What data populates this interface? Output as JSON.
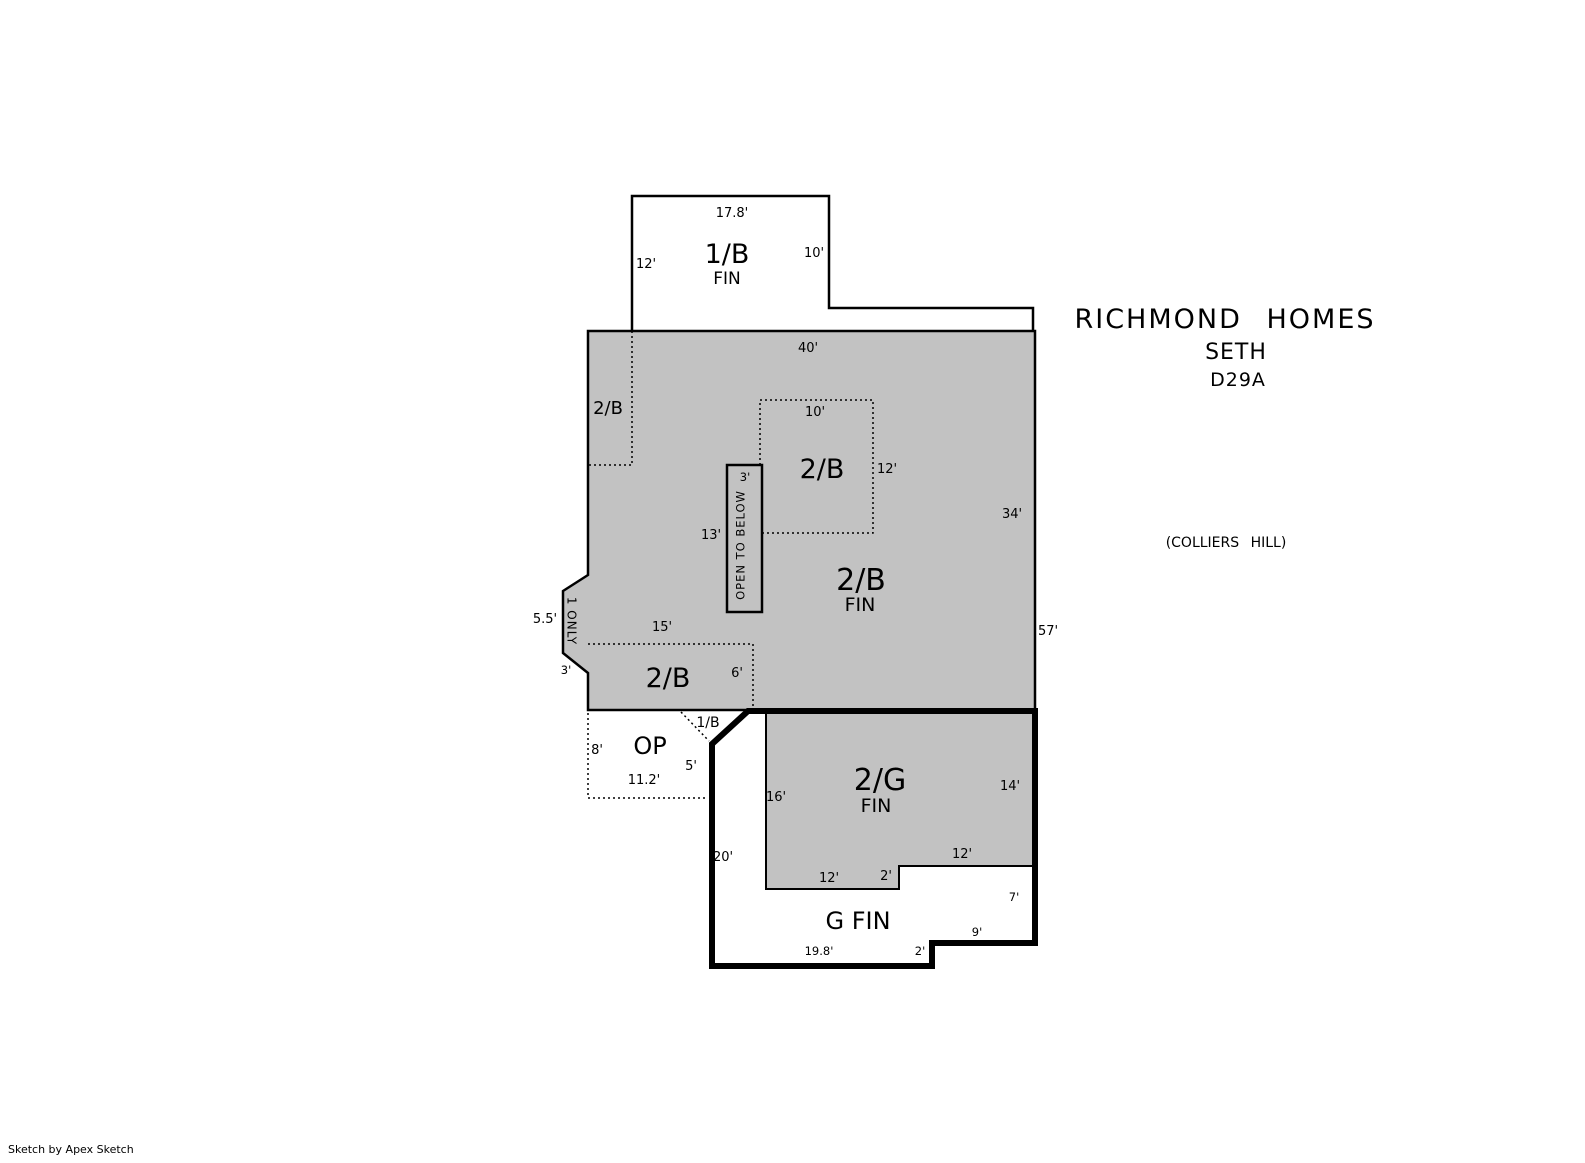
{
  "header": {
    "title": "RICHMOND HOMES",
    "model": "SETH",
    "plan_code": "D29A",
    "community": "(COLLIERS HILL)"
  },
  "credit": "Sketch by Apex Sketch",
  "upper_box": {
    "name": "1/B",
    "status": "FIN",
    "dim_top": "17.8'",
    "dim_left": "12'",
    "dim_right": "10'"
  },
  "main_area": {
    "name": "2/B",
    "status": "FIN",
    "dim_top": "40'",
    "dim_right_inner": "34'",
    "dim_right_outer": "57'",
    "room_top_left": {
      "name": "2/B"
    },
    "room_middle": {
      "name": "2/B",
      "dim_top": "10'",
      "dim_right": "12'"
    },
    "open_to_below": {
      "label": "OPEN TO BELOW",
      "dim_width": "3'",
      "dim_left": "13'"
    },
    "bump": {
      "label": "1 ONLY",
      "dim_outer": "5.5'",
      "dim_bottom": "3'"
    },
    "room_bottom_left": {
      "name": "2/B",
      "dim_top": "15'",
      "dim_right": "6'"
    }
  },
  "open_porch": {
    "name": "OP",
    "corner_label": "1/B",
    "dim_left": "8'",
    "dim_bottom": "11.2'",
    "dim_right": "5'"
  },
  "garage_upper": {
    "name": "2/G",
    "status": "FIN",
    "dim_left": "16'",
    "dim_right": "14'",
    "dim_step_top": "12'",
    "dim_bottom": "12'",
    "dim_bottom_step": "2'"
  },
  "garage": {
    "name": "G FIN",
    "dim_left": "20'",
    "dim_bottom": "19.8'",
    "dim_bottom_step": "2'",
    "dim_step": "9'",
    "dim_right": "7'"
  }
}
